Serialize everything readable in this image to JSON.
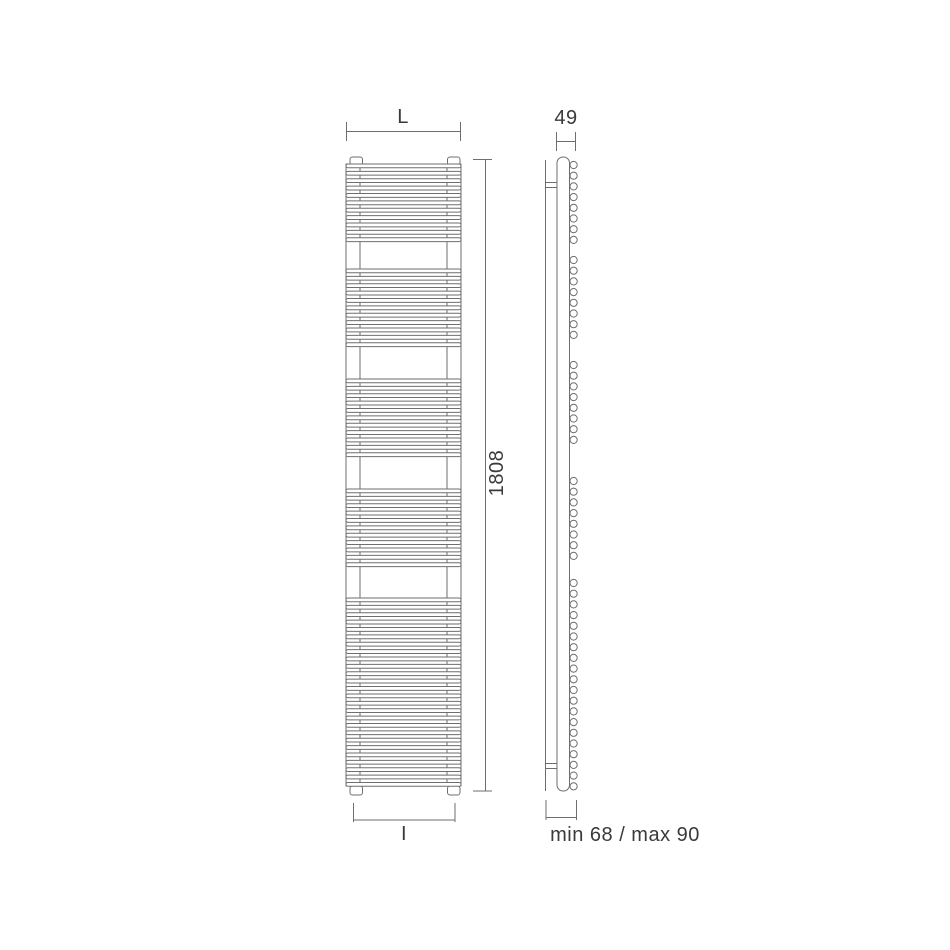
{
  "colors": {
    "background": "#ffffff",
    "line": "#6e6e6e",
    "dimension_line": "#6e6e6e",
    "text": "#3a3a3a",
    "fill": "#ffffff"
  },
  "labels": {
    "width_top": "L",
    "depth": "49",
    "height": "1808",
    "width_bottom": "I",
    "wall_distance": "min 68 / max 90"
  },
  "diagram": {
    "front_view": {
      "x": 346,
      "width": 115,
      "collector_width": 14,
      "top": 157,
      "tab": {
        "left_x": 350,
        "right_x": 447.5,
        "y": 157,
        "width": 12.5,
        "height": 8
      },
      "feet": {
        "y": 786,
        "height": 9
      },
      "rung_height": 3.8,
      "rung_pitch": 7.38,
      "rung_groups": [
        {
          "y": 164,
          "count": 11
        },
        {
          "y": 269,
          "count": 11
        },
        {
          "y": 379,
          "count": 11
        },
        {
          "y": 489,
          "count": 11
        },
        {
          "y": 598,
          "count": 26
        }
      ]
    },
    "side_view": {
      "wall_line": {
        "x": 545.5,
        "y1": 160,
        "y2": 791
      },
      "bar": {
        "x": 557,
        "y": 157,
        "width": 12.5,
        "height": 634,
        "radius": 6
      },
      "brackets": [
        {
          "y1": 182.5,
          "y2": 187.5
        },
        {
          "y1": 763.5,
          "y2": 768.5
        }
      ],
      "circle": {
        "cx": 573.6,
        "r": 3.6,
        "pitch": 10.7
      },
      "circle_groups": [
        {
          "y": 165,
          "count": 8
        },
        {
          "y": 260,
          "count": 8
        },
        {
          "y": 365,
          "count": 8
        },
        {
          "y": 481,
          "count": 8
        },
        {
          "y": 583,
          "count": 20
        }
      ]
    },
    "dimensions": [
      {
        "name": "dim-width-top",
        "line": [
          346.5,
          131.5,
          460.5,
          131.5
        ],
        "ticks": [
          [
            346.5,
            122,
            346.5,
            141
          ],
          [
            460.5,
            122,
            460.5,
            141
          ]
        ]
      },
      {
        "name": "dim-depth",
        "line": [
          556.5,
          141.5,
          575.5,
          141.5
        ],
        "ticks": [
          [
            556.5,
            132,
            556.5,
            151
          ],
          [
            575.5,
            132,
            575.5,
            151
          ]
        ]
      },
      {
        "name": "dim-height",
        "line": [
          485.5,
          159.5,
          485.5,
          791
        ],
        "ticks": [
          [
            473,
            159.5,
            492,
            159.5
          ],
          [
            473,
            791,
            492,
            791
          ]
        ]
      },
      {
        "name": "dim-width-bottom",
        "line": [
          353.5,
          820,
          455,
          820
        ],
        "ticks": [
          [
            353.5,
            803,
            353.5,
            822
          ],
          [
            455,
            803,
            455,
            822
          ]
        ]
      },
      {
        "name": "dim-wall-distance",
        "line": [
          546,
          817.5,
          576.5,
          817.5
        ],
        "ticks": [
          [
            546,
            800,
            546,
            820
          ],
          [
            576.5,
            800,
            576.5,
            820
          ]
        ]
      }
    ]
  }
}
